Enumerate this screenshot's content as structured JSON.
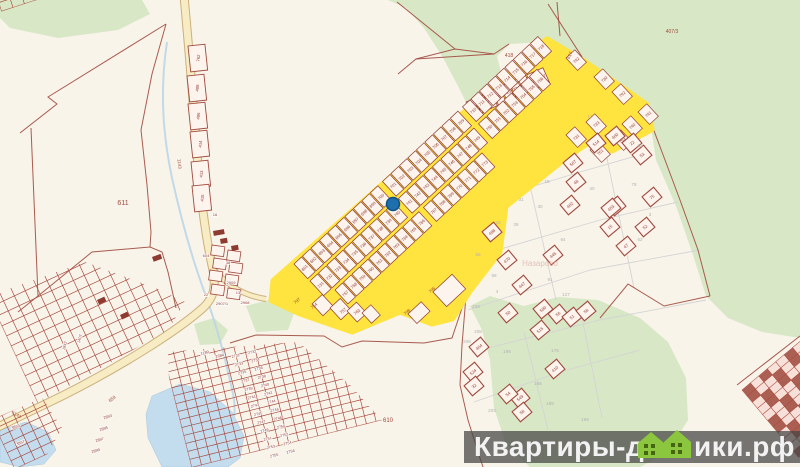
{
  "watermark": {
    "part1": "Квартиры-до",
    "part2": "ики.рф",
    "icon": "green-houses-icon"
  },
  "colors": {
    "bg": "#f8f4ea",
    "forest": "#d8e7c6",
    "water": "#c3dcee",
    "stream": "#b9d4e8",
    "roadFill": "#f7ecc4",
    "roadEdge": "#bf9f62",
    "boundary": "#a14a3e",
    "parcelStroke": "#8e3a30",
    "parcelFill": "#fdf4ee",
    "yellow": "#ffe33e",
    "numRed": "#8e3a30",
    "gray": "#b2b2b2",
    "pink": "#dfaea6",
    "marker": "#1d6fae",
    "markerEdge": "#0f5181",
    "wmBar": "rgba(68,68,68,0.73)",
    "wmText": "#f2f2f2",
    "wmGreen": "#8cc63e",
    "wmWindow": "#46650f",
    "building": "#8e3a30",
    "grid": "#a8493d",
    "gridFill": "#f7ded7"
  },
  "marker": {
    "x": 393,
    "y": 204,
    "r": 6.5
  },
  "forest": [
    [
      [
        388,
        0
      ],
      [
        406,
        8
      ],
      [
        424,
        28
      ],
      [
        442,
        56
      ],
      [
        458,
        86
      ],
      [
        468,
        106
      ],
      [
        482,
        114
      ],
      [
        496,
        98
      ],
      [
        502,
        76
      ],
      [
        497,
        56
      ],
      [
        510,
        44
      ],
      [
        544,
        42
      ],
      [
        560,
        58
      ],
      [
        586,
        64
      ],
      [
        648,
        108
      ],
      [
        656,
        160
      ],
      [
        676,
        206
      ],
      [
        692,
        252
      ],
      [
        706,
        296
      ],
      [
        728,
        318
      ],
      [
        762,
        332
      ],
      [
        800,
        338
      ],
      [
        800,
        0
      ]
    ],
    [
      [
        470,
        306
      ],
      [
        490,
        296
      ],
      [
        524,
        306
      ],
      [
        558,
        297
      ],
      [
        598,
        300
      ],
      [
        640,
        318
      ],
      [
        668,
        342
      ],
      [
        686,
        378
      ],
      [
        688,
        420
      ],
      [
        668,
        452
      ],
      [
        640,
        467
      ],
      [
        530,
        467
      ],
      [
        506,
        444
      ],
      [
        494,
        408
      ],
      [
        490,
        360
      ],
      [
        482,
        330
      ]
    ],
    [
      [
        0,
        0
      ],
      [
        142,
        0
      ],
      [
        150,
        14
      ],
      [
        118,
        30
      ],
      [
        58,
        38
      ],
      [
        10,
        28
      ],
      [
        0,
        18
      ]
    ],
    [
      [
        194,
        324
      ],
      [
        214,
        318
      ],
      [
        228,
        330
      ],
      [
        220,
        344
      ],
      [
        200,
        345
      ]
    ],
    [
      [
        246,
        306
      ],
      [
        280,
        297
      ],
      [
        295,
        310
      ],
      [
        288,
        330
      ],
      [
        256,
        332
      ]
    ]
  ],
  "water": [
    [
      [
        152,
        396
      ],
      [
        180,
        384
      ],
      [
        210,
        392
      ],
      [
        232,
        412
      ],
      [
        244,
        436
      ],
      [
        240,
        458
      ],
      [
        228,
        467
      ],
      [
        162,
        467
      ],
      [
        148,
        438
      ],
      [
        146,
        414
      ]
    ],
    [
      [
        0,
        430
      ],
      [
        26,
        422
      ],
      [
        48,
        432
      ],
      [
        56,
        450
      ],
      [
        44,
        464
      ],
      [
        20,
        467
      ],
      [
        0,
        462
      ]
    ]
  ],
  "stream": "M167,42 C159,95 164,140 172,178 C180,214 190,252 203,288 C212,312 222,345 228,372 C233,392 236,404 234,416",
  "roads": [
    {
      "d": "M184,-4 C190,60 193,100 196,140 C199,185 205,235 213,270 C216,287 214,297 204,307 C180,329 122,366 62,396 L-4,428",
      "w": 7
    },
    {
      "d": "M212,268 C230,288 246,296 266,299",
      "w": 4
    }
  ],
  "redlines": [
    "M166,24 L48,97 L57,104 L20,133",
    "M31,128 L38,296",
    "M38,296 L18,312",
    "M38,296 L92,252 L150,247 L162,252 L168,272 L176,308",
    "M166,24 L152,74 L141,130 L147,185 L151,232 L150,247",
    "M397,2 L455,49",
    "M398,74 L416,59 L455,49 L494,54 L509,44",
    "M416,59 L494,54",
    "M548,4 L584,60",
    "M557,2 L560,36",
    "M230,343 L256,335 L324,336 L342,347 L362,341 L424,343 L452,338 L466,296",
    "M466,296 L462,345 L460,385 L468,420 L478,452 L483,467",
    "M645,107 L662,152 L680,200 L698,250 L710,296",
    "M710,296 L664,306 L628,284 L600,318",
    "M737,385 L800,336"
  ],
  "graylines": [
    "M470,155 L560,128 L646,112",
    "M472,205 L580,172 L650,152",
    "M470,258 L600,220 L678,202",
    "M468,310 L590,270 L700,250",
    "M520,142 L556,300",
    "M600,125 L634,288",
    "M472,352 L600,320 L706,300",
    "M474,402 L560,372 L640,350",
    "M524,332 L548,430",
    "M582,318 L602,418"
  ],
  "denseGrids": [
    {
      "x": 160,
      "y": 340,
      "rot": -14,
      "cols": 26,
      "rows": 16,
      "cw": 10,
      "ch": 8.2,
      "dark": false,
      "clip": [
        [
          168,
          352
        ],
        [
          298,
          342
        ],
        [
          350,
          385
        ],
        [
          398,
          438
        ],
        [
          400,
          467
        ],
        [
          172,
          467
        ]
      ]
    },
    {
      "x": -12,
      "y": 296,
      "rot": -25,
      "cols": 16,
      "rows": 14,
      "cw": 12,
      "ch": 11,
      "dark": false,
      "clip": [
        [
          0,
          292
        ],
        [
          85,
          262
        ],
        [
          160,
          290
        ],
        [
          185,
          302
        ],
        [
          168,
          330
        ],
        [
          108,
          364
        ],
        [
          58,
          392
        ],
        [
          28,
          408
        ],
        [
          0,
          420
        ]
      ]
    },
    {
      "x": -8,
      "y": 420,
      "rot": -25,
      "cols": 6,
      "rows": 6,
      "cw": 11,
      "ch": 9,
      "dark": false,
      "clip": [
        [
          0,
          416
        ],
        [
          42,
          398
        ],
        [
          62,
          428
        ],
        [
          40,
          467
        ],
        [
          0,
          467
        ]
      ]
    },
    {
      "x": -4,
      "y": -6,
      "rot": -18,
      "cols": 6,
      "rows": 2,
      "cw": 12,
      "ch": 9,
      "dark": false,
      "clip": [
        [
          0,
          0
        ],
        [
          60,
          0
        ],
        [
          66,
          8
        ],
        [
          20,
          26
        ],
        [
          0,
          22
        ]
      ]
    },
    {
      "x": 742,
      "y": 390,
      "rot": -40,
      "cols": 8,
      "rows": 11,
      "cw": 11,
      "ch": 8,
      "dark": true,
      "clip": [
        [
          698,
          467
        ],
        [
          738,
          388
        ],
        [
          800,
          336
        ],
        [
          800,
          467
        ]
      ]
    }
  ],
  "roadParcels": [
    {
      "n": "762",
      "x": 188,
      "y": 46
    },
    {
      "n": "408",
      "x": 187,
      "y": 76
    },
    {
      "n": "406",
      "x": 188,
      "y": 104
    },
    {
      "n": "414",
      "x": 190,
      "y": 132
    },
    {
      "n": "413",
      "x": 191,
      "y": 162
    },
    {
      "n": "415",
      "x": 192,
      "y": 186
    }
  ],
  "bendRects": [
    [
      212,
      245
    ],
    [
      228,
      250
    ],
    [
      214,
      258
    ],
    [
      230,
      262
    ],
    [
      210,
      270
    ],
    [
      226,
      274
    ],
    [
      212,
      284
    ],
    [
      228,
      288
    ]
  ],
  "buildings": [
    [
      213,
      231,
      11,
      5,
      -10
    ],
    [
      220,
      239,
      7,
      5,
      -10
    ],
    [
      231,
      246,
      7,
      5,
      -10
    ],
    [
      152,
      257,
      9,
      5,
      -20
    ],
    [
      97,
      300,
      8,
      5,
      -25
    ],
    [
      120,
      315,
      8,
      5,
      -25
    ]
  ],
  "yellowZone": {
    "outline": [
      [
        547,
        40
      ],
      [
        584,
        62
      ],
      [
        646,
        105
      ],
      [
        651,
        129
      ],
      [
        612,
        150
      ],
      [
        590,
        141
      ],
      [
        566,
        157
      ],
      [
        505,
        206
      ],
      [
        499,
        252
      ],
      [
        469,
        291
      ],
      [
        452,
        318
      ],
      [
        432,
        323
      ],
      [
        400,
        311
      ],
      [
        352,
        331
      ],
      [
        300,
        313
      ],
      [
        272,
        300
      ],
      [
        274,
        281
      ]
    ],
    "rows": [
      {
        "x": 466,
        "y": 102,
        "rot": -24,
        "cw": 9.5,
        "ch": 16,
        "nums": [
          "719",
          "720",
          "721",
          "722",
          "723",
          "724",
          "725",
          "726",
          "727"
        ]
      },
      {
        "x": 294,
        "y": 264,
        "rot": -43,
        "cw": 11.6,
        "ch": 20,
        "nums": [
          "691",
          "692",
          "693",
          "694",
          "695",
          "696",
          "697",
          "698",
          "699",
          "700",
          "701",
          "702",
          "703",
          "704",
          "705",
          "706",
          "707",
          "708",
          "709",
          "710",
          "711",
          "712",
          "713",
          "714",
          "715",
          "716",
          "717",
          "718"
        ]
      },
      {
        "x": 310,
        "y": 281,
        "rot": -43,
        "cw": 11.6,
        "ch": 20,
        "nums": [
          "731",
          "732",
          "733",
          "734",
          "735",
          "736",
          "737",
          "738",
          "739",
          "740",
          "741",
          "742",
          "743",
          "744",
          "745",
          "746",
          "747",
          "748",
          "749",
          "750",
          "751",
          "752",
          "753",
          "754",
          "755",
          "756"
        ]
      },
      {
        "x": 335,
        "y": 290,
        "rot": -43,
        "cw": 11.6,
        "ch": 19,
        "nums": [
          "757",
          "758",
          "759",
          "760",
          "761",
          "762",
          "763",
          "764",
          "765",
          "766",
          "767",
          "768",
          "769",
          "770",
          "771",
          "772",
          "773"
        ]
      }
    ],
    "gapAfter": [
      9,
      18
    ],
    "gap": 5,
    "extras": [
      {
        "n": "742",
        "x": 566,
        "y": 58
      },
      {
        "n": "730",
        "x": 594,
        "y": 77
      },
      {
        "n": "792",
        "x": 612,
        "y": 92
      },
      {
        "n": "733",
        "x": 586,
        "y": 122
      },
      {
        "n": "740",
        "x": 622,
        "y": 124
      },
      {
        "n": "731",
        "x": 566,
        "y": 135
      },
      {
        "n": "751",
        "x": 590,
        "y": 150
      },
      {
        "n": "753",
        "x": 612,
        "y": 138
      },
      {
        "n": "741",
        "x": 638,
        "y": 112
      }
    ],
    "bottomParcels": [
      [
        433,
        292,
        26,
        20
      ],
      [
        408,
        314,
        18,
        13
      ],
      [
        312,
        304,
        14,
        16
      ],
      [
        330,
        308,
        14,
        16
      ],
      [
        347,
        311,
        13,
        15
      ],
      [
        362,
        313,
        12,
        14
      ]
    ],
    "edgeLabels": [
      {
        "t": "797",
        "x": 298,
        "y": 302
      },
      {
        "t": "754",
        "x": 315,
        "y": 307
      },
      {
        "t": "757",
        "x": 344,
        "y": 312
      },
      {
        "t": "763",
        "x": 358,
        "y": 313
      },
      {
        "t": "796",
        "x": 408,
        "y": 313
      },
      {
        "t": "795",
        "x": 433,
        "y": 291
      }
    ]
  },
  "scatteredParcels": [
    {
      "n": "514",
      "x": 596,
      "y": 143
    },
    {
      "n": "507",
      "x": 573,
      "y": 163
    },
    {
      "n": "402",
      "x": 570,
      "y": 205
    },
    {
      "n": "400",
      "x": 615,
      "y": 136
    },
    {
      "n": "22",
      "x": 632,
      "y": 143
    },
    {
      "n": "53",
      "x": 642,
      "y": 155
    },
    {
      "n": "36",
      "x": 616,
      "y": 206
    },
    {
      "n": "75",
      "x": 652,
      "y": 197
    },
    {
      "n": "52",
      "x": 645,
      "y": 227
    },
    {
      "n": "15",
      "x": 610,
      "y": 227
    },
    {
      "n": "47",
      "x": 626,
      "y": 246
    },
    {
      "n": "498",
      "x": 492,
      "y": 232
    },
    {
      "n": "470",
      "x": 507,
      "y": 260
    },
    {
      "n": "445",
      "x": 553,
      "y": 255
    },
    {
      "n": "447",
      "x": 522,
      "y": 285
    },
    {
      "n": "404",
      "x": 479,
      "y": 347
    },
    {
      "n": "524",
      "x": 473,
      "y": 372
    },
    {
      "n": "32",
      "x": 474,
      "y": 386
    },
    {
      "n": "410",
      "x": 555,
      "y": 369
    },
    {
      "n": "590",
      "x": 543,
      "y": 309
    },
    {
      "n": "56",
      "x": 558,
      "y": 314
    },
    {
      "n": "51",
      "x": 572,
      "y": 317
    },
    {
      "n": "58",
      "x": 586,
      "y": 311
    },
    {
      "n": "515",
      "x": 540,
      "y": 330
    },
    {
      "n": "50",
      "x": 508,
      "y": 313
    },
    {
      "n": "549",
      "x": 520,
      "y": 398
    },
    {
      "n": "54",
      "x": 508,
      "y": 394
    },
    {
      "n": "58",
      "x": 522,
      "y": 412
    },
    {
      "n": "453",
      "x": 611,
      "y": 208
    },
    {
      "n": "48",
      "x": 576,
      "y": 182
    }
  ],
  "grayNumbers": [
    {
      "t": "31",
      "x": 521,
      "y": 201
    },
    {
      "t": "30",
      "x": 540,
      "y": 208
    },
    {
      "t": "23",
      "x": 498,
      "y": 224
    },
    {
      "t": "28",
      "x": 516,
      "y": 226
    },
    {
      "t": "64",
      "x": 563,
      "y": 241
    },
    {
      "t": "62",
      "x": 640,
      "y": 241
    },
    {
      "t": "55",
      "x": 478,
      "y": 256
    },
    {
      "t": "58",
      "x": 494,
      "y": 277
    },
    {
      "t": "91",
      "x": 550,
      "y": 281
    },
    {
      "t": "4",
      "x": 497,
      "y": 293
    },
    {
      "t": "127",
      "x": 566,
      "y": 296
    },
    {
      "t": "18",
      "x": 547,
      "y": 183
    },
    {
      "t": "40",
      "x": 592,
      "y": 190
    },
    {
      "t": "3",
      "x": 650,
      "y": 216
    },
    {
      "t": "78",
      "x": 634,
      "y": 186
    },
    {
      "t": "11",
      "x": 590,
      "y": 118
    },
    {
      "t": "33",
      "x": 640,
      "y": 147
    },
    {
      "t": "233",
      "x": 476,
      "y": 308
    },
    {
      "t": "208",
      "x": 478,
      "y": 333
    },
    {
      "t": "206",
      "x": 467,
      "y": 343
    },
    {
      "t": "196",
      "x": 507,
      "y": 353
    },
    {
      "t": "175",
      "x": 555,
      "y": 352
    },
    {
      "t": "185",
      "x": 538,
      "y": 385
    },
    {
      "t": "203",
      "x": 492,
      "y": 412
    },
    {
      "t": "189",
      "x": 550,
      "y": 405
    },
    {
      "t": "169",
      "x": 585,
      "y": 421
    }
  ],
  "labels": [
    {
      "t": "611",
      "x": 123,
      "y": 205,
      "s": 7,
      "rot": 0,
      "c": "red"
    },
    {
      "t": "610",
      "x": 388,
      "y": 422,
      "s": 6,
      "rot": 0,
      "c": "red"
    },
    {
      "t": "407/3",
      "x": 672,
      "y": 33,
      "s": 5,
      "rot": 0,
      "c": "red"
    },
    {
      "t": "418",
      "x": 509,
      "y": 57,
      "s": 5,
      "rot": 0,
      "c": "red"
    },
    {
      "t": "617",
      "x": 571,
      "y": 56,
      "s": 4.5,
      "rot": -65,
      "c": "red"
    },
    {
      "t": "1143",
      "x": 178,
      "y": 164,
      "s": 4.5,
      "rot": 84,
      "c": "red"
    },
    {
      "t": "1143",
      "x": 16,
      "y": 416,
      "s": 4.5,
      "rot": 28,
      "c": "red"
    },
    {
      "t": "859",
      "x": 113,
      "y": 400,
      "s": 4.5,
      "rot": -36,
      "c": "red"
    },
    {
      "t": "Назарово",
      "x": 540,
      "y": 266,
      "s": 8,
      "rot": 0,
      "c": "pink"
    }
  ],
  "villageLabels": [
    {
      "t": "604",
      "x": 206,
      "y": 257,
      "rot": 0
    },
    {
      "t": "16",
      "x": 215,
      "y": 216,
      "rot": 0
    },
    {
      "t": "38",
      "x": 228,
      "y": 264,
      "rot": 0
    },
    {
      "t": "2909",
      "x": 231,
      "y": 284,
      "rot": 0
    },
    {
      "t": "13",
      "x": 238,
      "y": 294,
      "rot": 0
    },
    {
      "t": "22",
      "x": 206,
      "y": 296,
      "rot": 0
    },
    {
      "t": "2908",
      "x": 245,
      "y": 304,
      "rot": 0
    },
    {
      "t": "2907/1",
      "x": 222,
      "y": 305,
      "rot": 0
    },
    {
      "t": "1842",
      "x": 66,
      "y": 346,
      "rot": -75
    },
    {
      "t": "1407",
      "x": 81,
      "y": 339,
      "rot": -75
    },
    {
      "t": "3893",
      "x": 16,
      "y": 428,
      "rot": -20
    },
    {
      "t": "3897",
      "x": 21,
      "y": 444,
      "rot": -20
    },
    {
      "t": "2893",
      "x": 108,
      "y": 418,
      "rot": -18
    },
    {
      "t": "2895",
      "x": 104,
      "y": 430,
      "rot": -18
    },
    {
      "t": "2897",
      "x": 100,
      "y": 441,
      "rot": -18
    },
    {
      "t": "2899",
      "x": 96,
      "y": 452,
      "rot": -18
    },
    {
      "t": "1189",
      "x": 205,
      "y": 354,
      "rot": -14
    },
    {
      "t": "2684",
      "x": 220,
      "y": 357,
      "rot": -14
    }
  ],
  "labelCols": {
    "x": 236,
    "y": 357,
    "start": 2731,
    "pairs": 13,
    "rowDx": 3.2,
    "rowDy": 8.3,
    "colDx": 16.5,
    "colDy": -3.8,
    "rot": -14,
    "size": 3.8
  }
}
